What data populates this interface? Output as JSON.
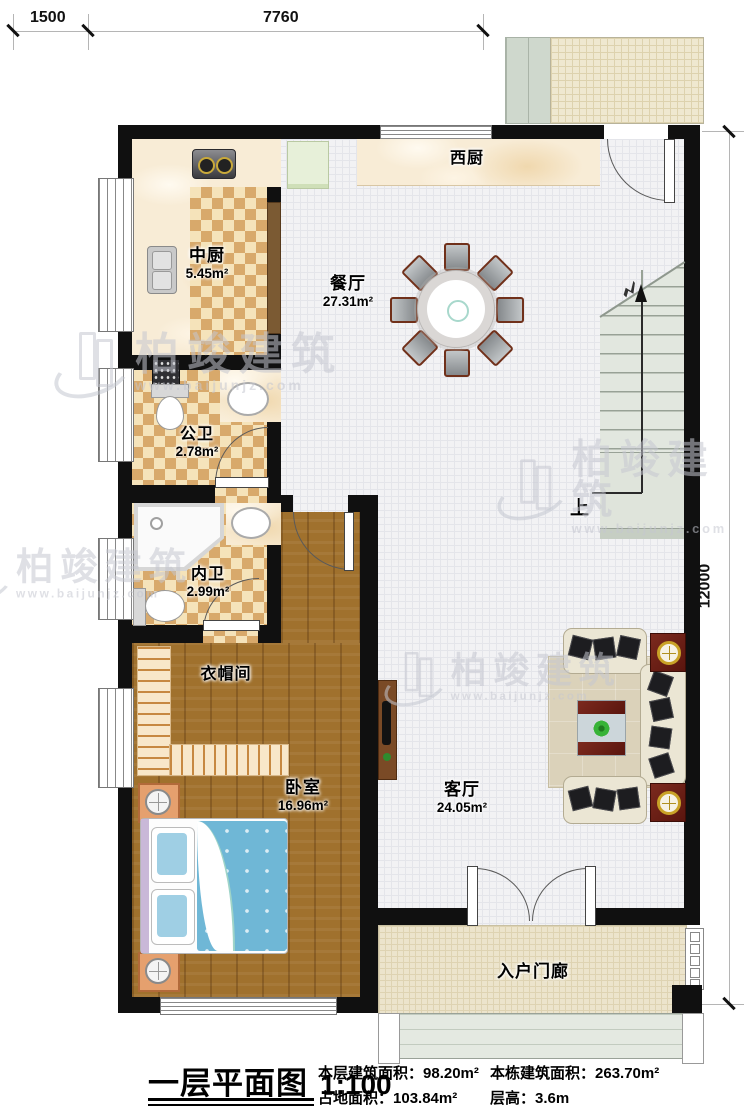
{
  "dimensions": {
    "top_segment_left": "1500",
    "top_segment_right": "7760",
    "right_side": "12000"
  },
  "rooms": {
    "west_kitchen": {
      "name": "西厨",
      "area": ""
    },
    "chinese_kitchen": {
      "name": "中厨",
      "area": "5.45m²"
    },
    "dining": {
      "name": "餐厅",
      "area": "27.31m²"
    },
    "public_bath": {
      "name": "公卫",
      "area": "2.78m²"
    },
    "inner_bath": {
      "name": "内卫",
      "area": "2.99m²"
    },
    "cloakroom": {
      "name": "衣帽间",
      "area": ""
    },
    "bedroom": {
      "name": "卧室",
      "area": "16.96m²"
    },
    "living": {
      "name": "客厅",
      "area": "24.05m²"
    },
    "porch": {
      "name": "入户门廊",
      "area": ""
    }
  },
  "stairs": {
    "direction_label": "上"
  },
  "title": {
    "name": "一层平面图",
    "scale": "1:100"
  },
  "stats": [
    {
      "label": "本层建筑面积：",
      "value": "98.20m²"
    },
    {
      "label": "本栋建筑面积：",
      "value": "263.70m²"
    },
    {
      "label": "占地面积：",
      "value": "103.84m²"
    },
    {
      "label": "层高：",
      "value": "3.6m"
    }
  ],
  "watermark": {
    "brand": "柏竣建筑",
    "url": "www.baijunjz.com"
  },
  "colors": {
    "wall": "#101010",
    "wood_floor": "#a0712d",
    "checker_dark": "#d8a96b",
    "checker_light": "#f5e3ba",
    "tile_floor": "#f2f2f4",
    "porch_floor": "#ece4cc",
    "stair_fill": "#e2e7df",
    "bed_blue": "#6fb7d6",
    "furniture_red": "#6e241c",
    "marble": "#f8ecd6"
  }
}
